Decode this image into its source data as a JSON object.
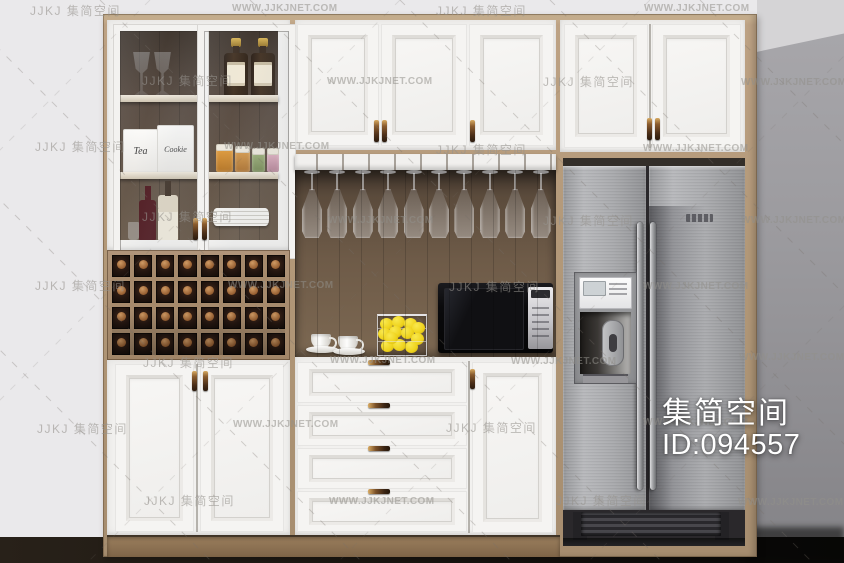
{
  "branding": {
    "logo_latin": "JJKJ",
    "brand_cn": "集简空间",
    "site_url": "WWW.JJKJNET.COM"
  },
  "id_badge": {
    "brand": "集简空间",
    "id_text": "ID:094557"
  },
  "display_cabinet": {
    "box_labels": [
      "Tea",
      "Cookie"
    ]
  },
  "wine_rack": {
    "cols": 8,
    "rows": 4
  },
  "glass_rack": {
    "glass_count": 10
  },
  "drawer_stack": {
    "count": 4
  },
  "colors": {
    "wood": "#b29878",
    "cork": "#b5793f",
    "lemon": "#efd31d",
    "steel": "#a9aaad",
    "microwave": "#0a0a0c",
    "wall_shadow": "#9b9a9e"
  },
  "watermarks": [
    {
      "k": "cn",
      "x": 30,
      "y": 2
    },
    {
      "k": "url",
      "x": 232,
      "y": 3
    },
    {
      "k": "cn",
      "x": 436,
      "y": 2
    },
    {
      "k": "url",
      "x": 644,
      "y": 3
    },
    {
      "k": "cn",
      "x": 142,
      "y": 72
    },
    {
      "k": "url",
      "x": 327,
      "y": 76
    },
    {
      "k": "cn",
      "x": 543,
      "y": 73
    },
    {
      "k": "url",
      "x": 741,
      "y": 77
    },
    {
      "k": "cn",
      "x": 35,
      "y": 138
    },
    {
      "k": "url",
      "x": 224,
      "y": 141
    },
    {
      "k": "cn",
      "x": 436,
      "y": 141
    },
    {
      "k": "url",
      "x": 643,
      "y": 143
    },
    {
      "k": "cn",
      "x": 142,
      "y": 208
    },
    {
      "k": "url",
      "x": 328,
      "y": 215
    },
    {
      "k": "cn",
      "x": 543,
      "y": 212
    },
    {
      "k": "url",
      "x": 741,
      "y": 215
    },
    {
      "k": "cn",
      "x": 35,
      "y": 277
    },
    {
      "k": "url",
      "x": 228,
      "y": 280
    },
    {
      "k": "cn",
      "x": 449,
      "y": 278
    },
    {
      "k": "url",
      "x": 643,
      "y": 281
    },
    {
      "k": "cn",
      "x": 143,
      "y": 354
    },
    {
      "k": "url",
      "x": 330,
      "y": 355
    },
    {
      "k": "url",
      "x": 511,
      "y": 356
    },
    {
      "k": "url",
      "x": 739,
      "y": 352
    },
    {
      "k": "cn",
      "x": 37,
      "y": 420
    },
    {
      "k": "url",
      "x": 233,
      "y": 419
    },
    {
      "k": "cn",
      "x": 446,
      "y": 419
    },
    {
      "k": "url",
      "x": 643,
      "y": 417
    },
    {
      "k": "cn",
      "x": 144,
      "y": 492
    },
    {
      "k": "url",
      "x": 329,
      "y": 496
    },
    {
      "k": "cn",
      "x": 556,
      "y": 492
    },
    {
      "k": "url",
      "x": 738,
      "y": 497
    }
  ]
}
